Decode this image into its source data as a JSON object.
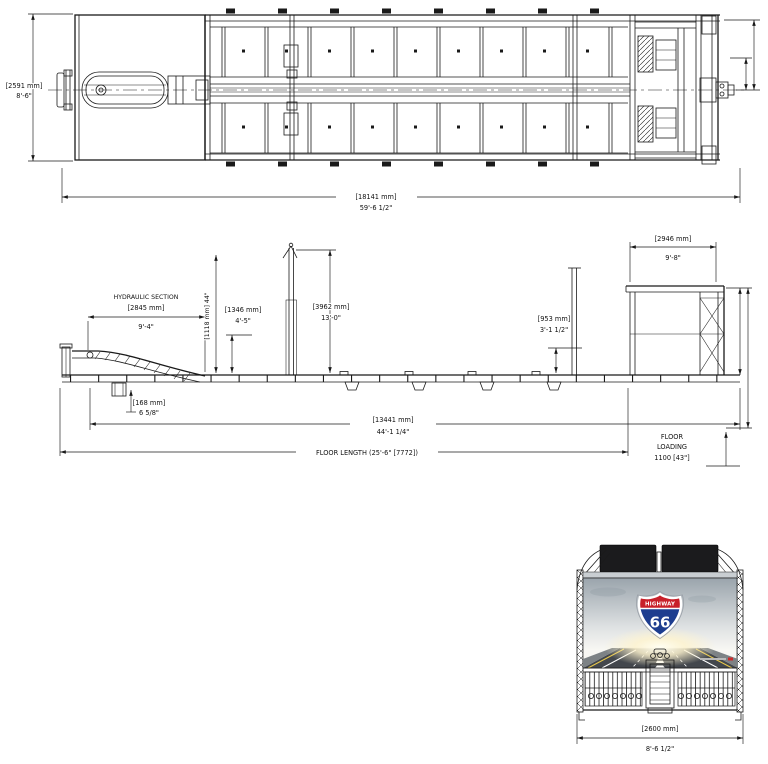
{
  "drawing": {
    "top_view": {
      "width_mm": "[2591 mm]",
      "width_imp": "8'-6\"",
      "overall_length_mm": "[18141 mm]",
      "overall_length_imp": "59'-6 1/2\""
    },
    "side_view": {
      "hydraulic_section_title": "HYDRAULIC SECTION",
      "hydraulic_section_mm": "[2845 mm]",
      "hydraulic_section_imp": "9'-4\"",
      "neck_height_note": "[1118 mm] 44\"",
      "front_height_mm": "[1346 mm]",
      "front_height_imp": "4'-5\"",
      "mast_height_mm": "[3962 mm]",
      "mast_height_imp": "13'-0\"",
      "mid_height_mm": "[953 mm]",
      "mid_height_imp": "3'-1 1/2\"",
      "rear_top_mm": "[2946 mm]",
      "rear_top_imp": "9'-8\"",
      "step_height_mm": "[168 mm]",
      "step_height_imp": "6 5/8\"",
      "main_length_mm": "[13441 mm]",
      "main_length_imp": "44'-1 1/4\"",
      "floor_length": "FLOOR LENGTH (25'-6\" [7772])",
      "floor_loading_1": "FLOOR",
      "floor_loading_2": "LOADING",
      "floor_loading_3": "1100 [43\"]"
    },
    "rear_view": {
      "sign_top": "HIGHWAY",
      "sign_number": "66",
      "width_mm": "[2600 mm]",
      "width_imp": "8'-6 1/2\""
    },
    "colors": {
      "line": "#1a1a1a",
      "panel_black": "#1b1b1d",
      "sign_red": "#c8202a",
      "sign_blue": "#1d3d8f",
      "sky_top": "#9aa4ac",
      "road": "#43474d"
    }
  }
}
